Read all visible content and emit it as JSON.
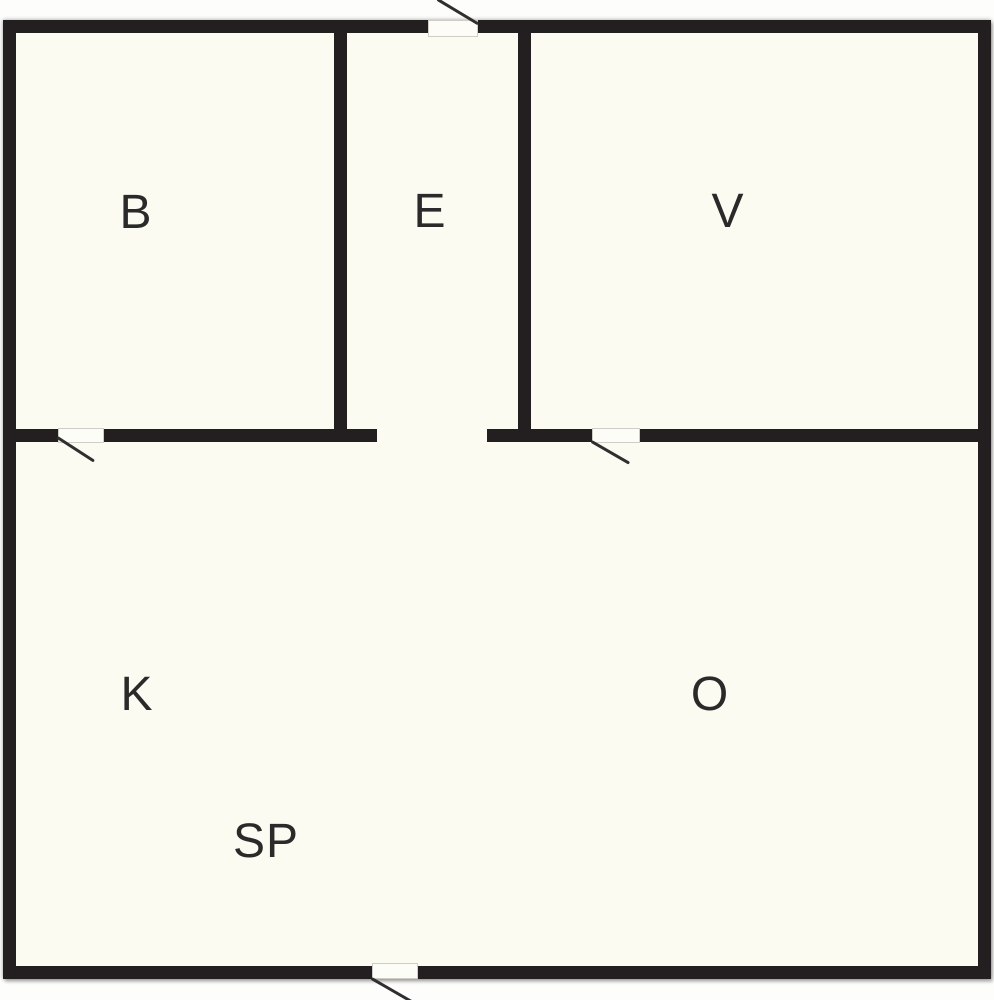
{
  "floor_plan": {
    "type": "apartment-floor-plan",
    "rooms": [
      {
        "code": "B"
      },
      {
        "code": "E"
      },
      {
        "code": "V"
      },
      {
        "code": "K"
      },
      {
        "code": "O"
      },
      {
        "code": "SP"
      }
    ],
    "door_count": 4,
    "colors": {
      "wall": "#231f20",
      "floor": "#fcfbf2",
      "swing": "#2f2f2f",
      "threshold": "#fdfdf8",
      "label": "#2a2a2a"
    }
  }
}
